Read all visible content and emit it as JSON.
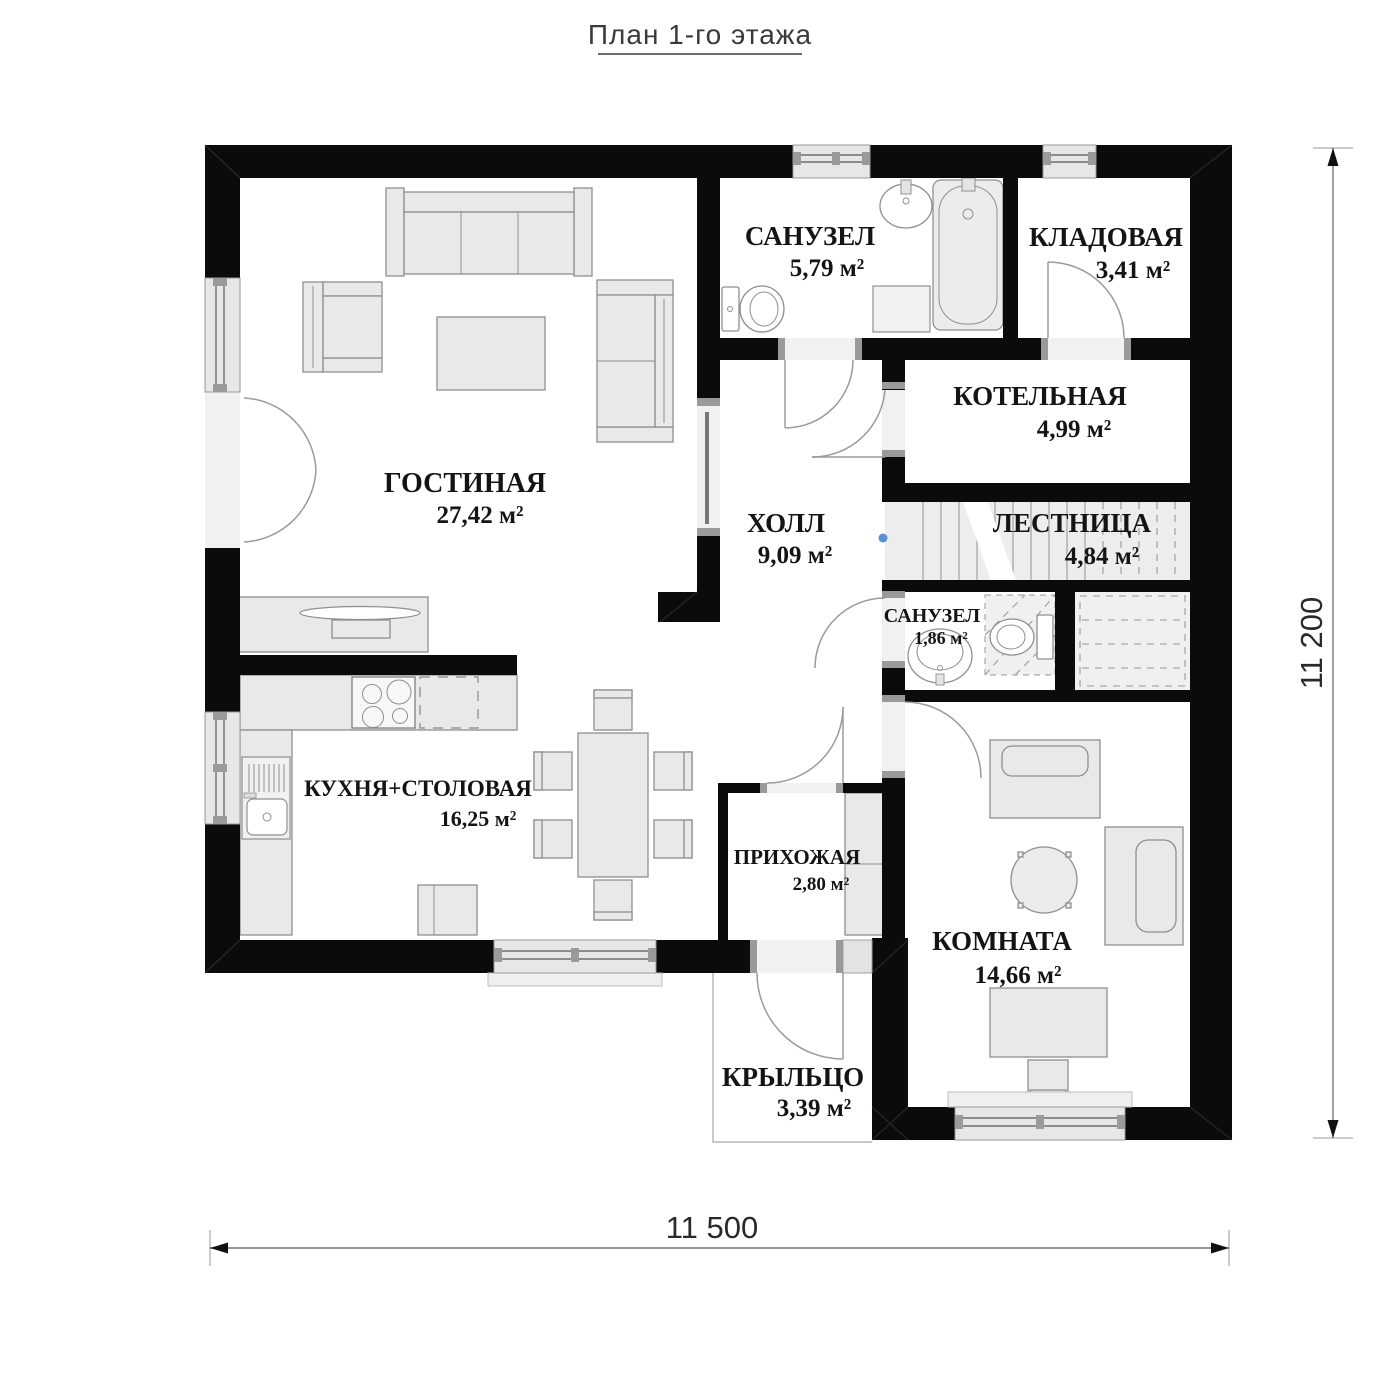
{
  "title": "План 1-го этажа",
  "rooms": {
    "living": {
      "name": "ГОСТИНАЯ",
      "area": "27,42 м²"
    },
    "bath1": {
      "name": "САНУЗЕЛ",
      "area": "5,79 м²"
    },
    "storage": {
      "name": "КЛАДОВАЯ",
      "area": "3,41 м²"
    },
    "boiler": {
      "name": "КОТЕЛЬНАЯ",
      "area": "4,99 м²"
    },
    "hall": {
      "name": "ХОЛЛ",
      "area": "9,09 м²"
    },
    "stairs": {
      "name": "ЛЕСТНИЦА",
      "area": "4,84 м²"
    },
    "bath2": {
      "name": "САНУЗЕЛ",
      "area": "1,86 м²"
    },
    "kitchen": {
      "name": "КУХНЯ+СТОЛОВАЯ",
      "area": "16,25 м²"
    },
    "entry": {
      "name": "ПРИХОЖАЯ",
      "area": "2,80 м²"
    },
    "room": {
      "name": "КОМНАТА",
      "area": "14,66 м²"
    },
    "porch": {
      "name": "КРЫЛЬЦО",
      "area": "3,39 м²"
    }
  },
  "dimensions": {
    "width": "11 500",
    "height": "11 200"
  },
  "colors": {
    "wall": "#0b0b0b",
    "furniture": "#e9e9e9",
    "marker_blue": "#5b8fd6"
  }
}
